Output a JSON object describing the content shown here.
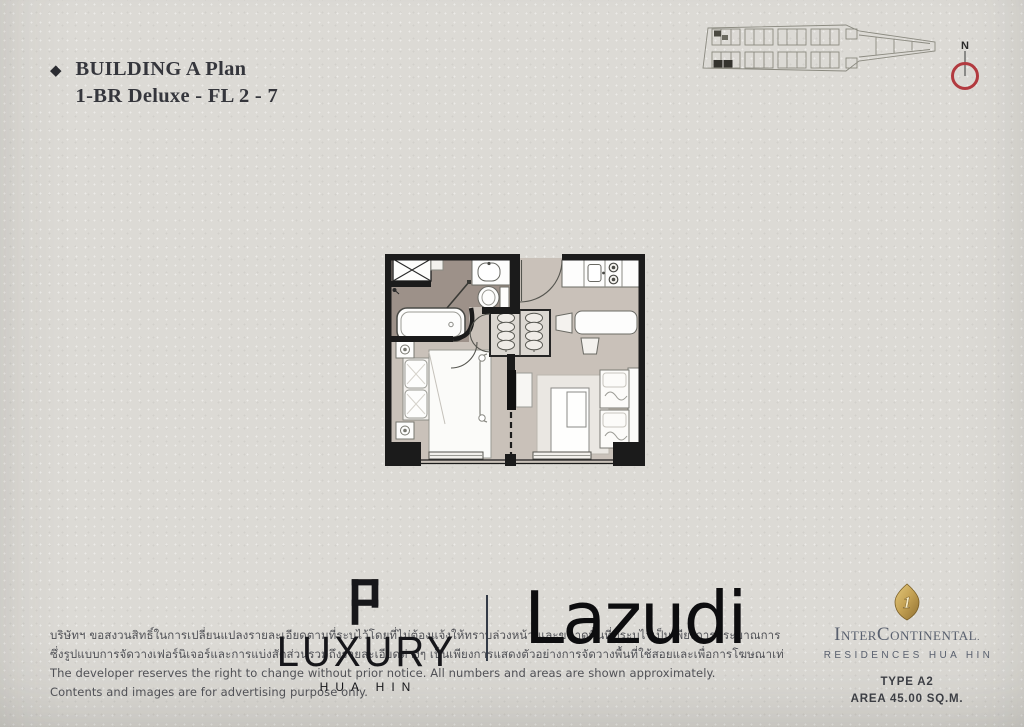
{
  "page": {
    "bg_color": "#dcdad5",
    "accent_red": "#b23a3f",
    "gold": "#c3a052"
  },
  "header": {
    "bullet_icon": "◆",
    "title_line1": "BUILDING A Plan",
    "title_line2": "1-BR Deluxe - FL 2 - 7"
  },
  "keyplan": {
    "compass_label": "N"
  },
  "floorplan": {
    "wall_color": "#1b1b1b",
    "floor_color": "#c9c1b9",
    "bath_floor_color": "#9d9189"
  },
  "disclaimer": {
    "th_line1": "บริษัทฯ ขอสงวนสิทธิ์ในการเปลี่ยนแปลงรายละเอียดตามที่ระบุไว้โดยที่ไม่ต้องแจ้งให้ทราบล่วงหน้า และขนาดพื้นที่ที่ระบุไว้เป็นเพียงการประมาณการ",
    "th_line2": "ซึ่งรูปแบบการจัดวางเฟอร์นิเจอร์และการแบ่งสัดส่วนรวมถึงรายละเอียดต่างๆ เป็นเพียงการแสดงตัวอย่างการจัดวางพื้นที่ใช้สอยและเพื่อการโฆษณาเท่านั้น",
    "en_line1": "The developer reserves the right to change without prior notice. All numbers and areas are shown approximately.",
    "en_line2": "Contents and images are for advertising purpose only."
  },
  "brands": {
    "luxury": {
      "wordmark": "LUXURY",
      "location": "HUA HIN"
    },
    "lazudi": {
      "wordmark": "Lazudi"
    },
    "intercontinental": {
      "emblem_glyph": "1",
      "name": "InterContinental",
      "name_suffix": ".",
      "residences": "RESIDENCES HUA HIN",
      "unit_type": "TYPE A2",
      "unit_area": "AREA 45.00 SQ.M."
    }
  }
}
